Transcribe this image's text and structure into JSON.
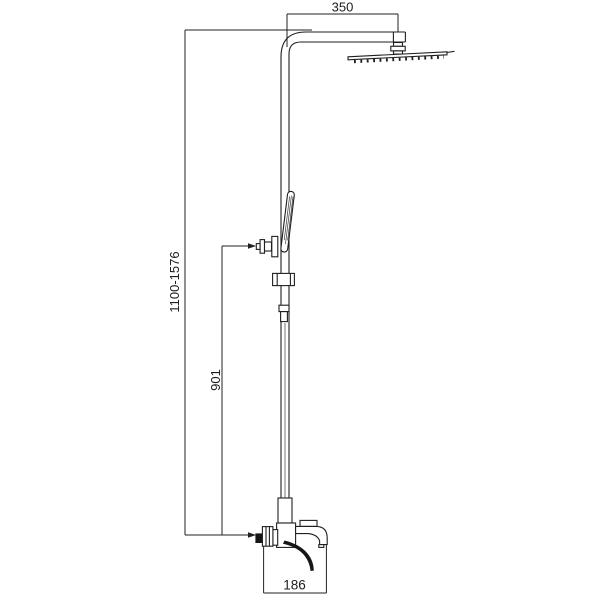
{
  "page": {
    "background": "#ffffff",
    "line_color": "#1f1f1f",
    "text_color": "#1c1c1c"
  },
  "drawing": {
    "labels": {
      "top_width": "350",
      "height_range": "1100-1576",
      "hand_shower_height": "901",
      "mixer_width": "186"
    }
  }
}
